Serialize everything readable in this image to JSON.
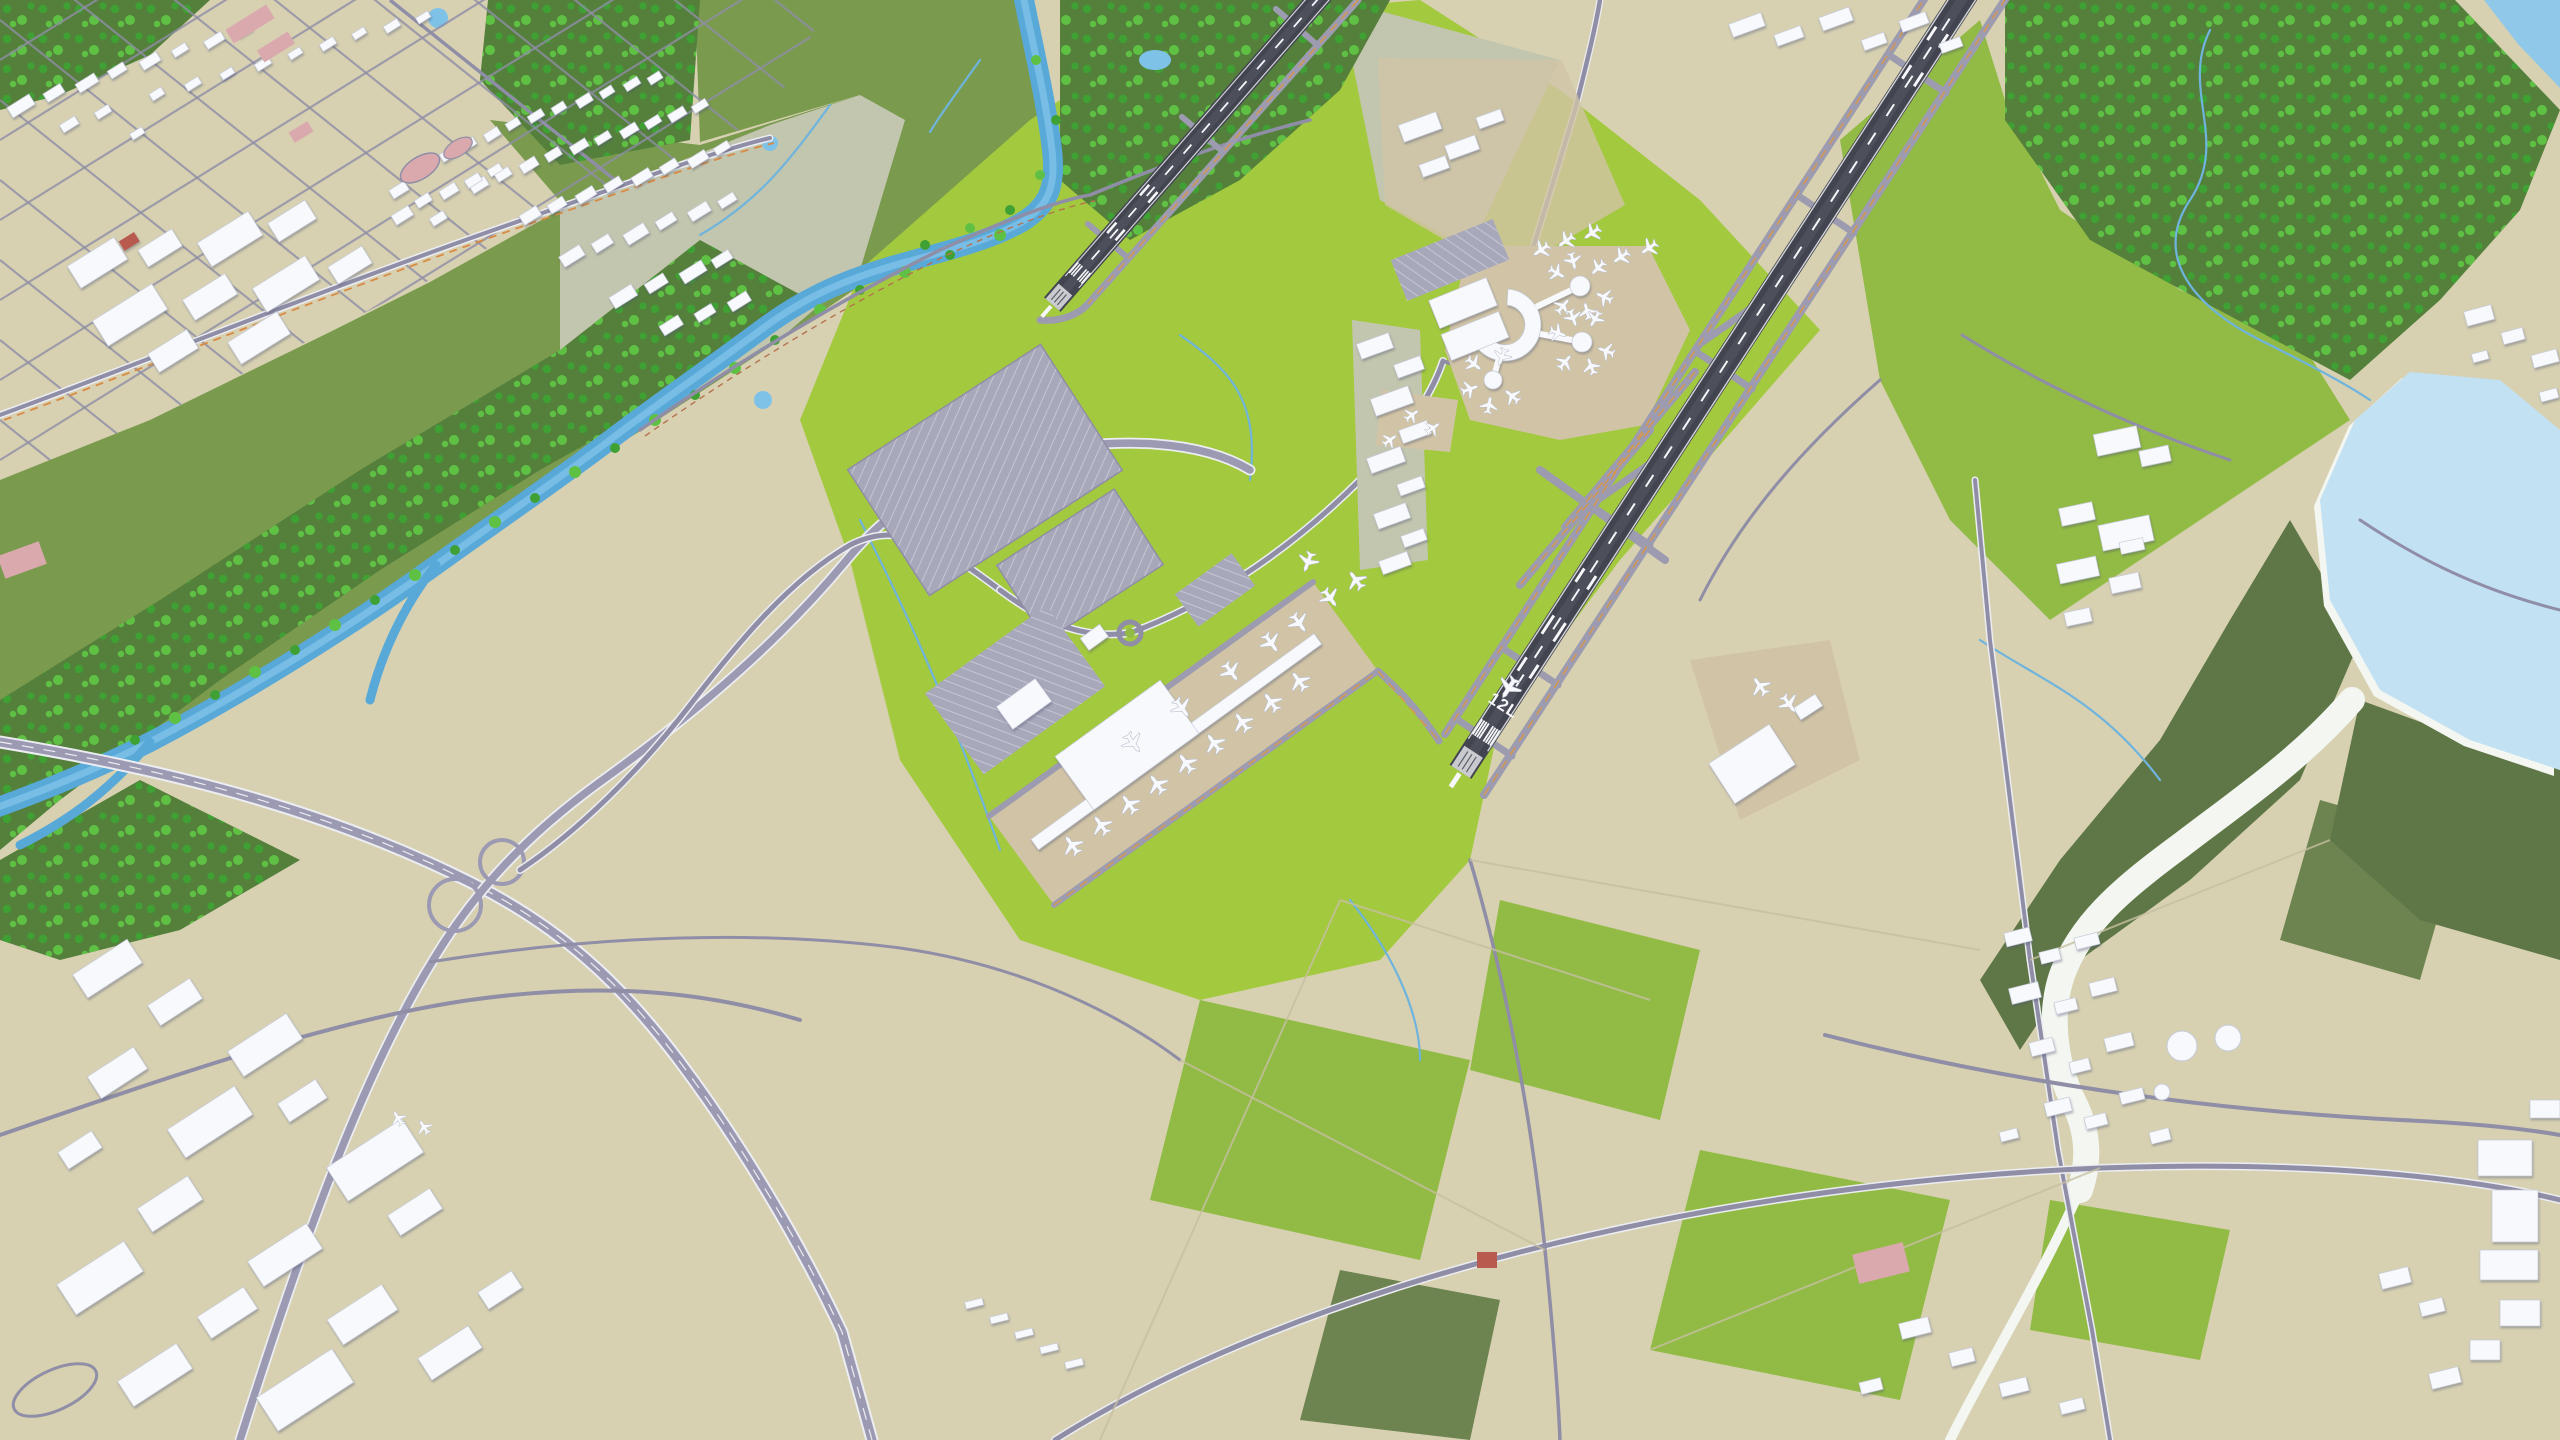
{
  "meta": {
    "type": "3d-aerial-airport-map",
    "description": "Isometric 3D city-model render of an international airport: two dark diagonal runways, crescent main terminal with three satellite concourses, long linear pier terminal with parked jets, taxiway network with orange centerlines, bright grass infields, a tree-lined river, a lake with white dry creek, a town street grid northwest, warehouse district southwest and farmland southeast.",
    "visible_text": "12L"
  },
  "labels": {
    "runway_designator": "12L"
  },
  "palette": {
    "base_land": "#d7d1b2",
    "land_light": "#ded9c0",
    "concrete_pale": "#c3c6ae",
    "grass_bright": "#a3c93e",
    "grass_mid": "#92bb45",
    "grass_dark": "#7a9a4e",
    "olive": "#6e8450",
    "olive_dark": "#5f7747",
    "forest": "#54803c",
    "tree_light": "#5fc143",
    "tree_mid": "#3fa133",
    "river": "#58a9d8",
    "river_light": "#7fc2e8",
    "lake": "#c2e1f2",
    "lake_deep": "#8fc8e8",
    "stream": "#6fb4dd",
    "creek_white": "#f3f6f1",
    "road": "#8f8ea6",
    "road_light": "#ecedf2",
    "highway": "#9b9ab2",
    "taxiway": "#9c9bb0",
    "taxi_center": "#e2973c",
    "runway": "#42454f",
    "runway_light": "#5a5e68",
    "marking": "#f6f7fa",
    "apron": "#d1c4a6",
    "parking": "#a8a8bb",
    "parking_line": "#cfcfdc",
    "building": "#f8f9fc",
    "building_edge": "#c5cad8",
    "pink": "#d9a9ae",
    "red_roof": "#b95a4f",
    "orange_line": "#d98a43",
    "rail_brown": "#b5724e",
    "field_line": "#c6bfa0"
  },
  "features": {
    "water": [
      "river",
      "lake",
      "corner-lake",
      "white-dry-creek",
      "ponds",
      "streams"
    ],
    "airport": [
      "runway-12l",
      "runway-northwest",
      "parallel-taxiways",
      "crescent-main-terminal",
      "satellite-concourse-1",
      "satellite-concourse-2",
      "satellite-concourse-3",
      "linear-pier-terminal",
      "terminal-hall",
      "parking-garages",
      "economy-parking-lots",
      "cargo-apron-northeast",
      "cargo-hangar-southeast",
      "access-roundabout",
      "terminal-loop-roads"
    ],
    "surroundings": [
      "town-grid-northwest",
      "stadium-oval",
      "warehouse-district-southwest",
      "highway-interchange",
      "village-southeast",
      "institutional-campus-east",
      "storage-tanks",
      "farm-fields",
      "riparian-forest",
      "forest-northeast",
      "marsh"
    ]
  },
  "aircraft": {
    "count": 47,
    "placements": [
      [
        1072,
        845,
        -36,
        1.15
      ],
      [
        1101,
        825,
        -36,
        1.15
      ],
      [
        1129,
        804,
        -36,
        1.15
      ],
      [
        1157,
        784,
        -36,
        1.15
      ],
      [
        1186,
        763,
        -36,
        1.15
      ],
      [
        1214,
        743,
        -36,
        1.15
      ],
      [
        1242,
        722,
        -36,
        1.15
      ],
      [
        1271,
        702,
        -36,
        1.15
      ],
      [
        1299,
        681,
        -36,
        1.15
      ],
      [
        1133,
        743,
        144,
        1.15
      ],
      [
        1182,
        708,
        144,
        1.15
      ],
      [
        1231,
        672,
        144,
        1.15
      ],
      [
        1271,
        643,
        144,
        1.15
      ],
      [
        1299,
        623,
        144,
        1.15
      ],
      [
        1330,
        598,
        144,
        1.1
      ],
      [
        1356,
        580,
        -36,
        1.1
      ],
      [
        1308,
        562,
        200,
        1.1
      ],
      [
        1604,
        297,
        -65,
        0.95
      ],
      [
        1587,
        311,
        -15,
        0.95
      ],
      [
        1563,
        306,
        40,
        0.95
      ],
      [
        1557,
        273,
        120,
        0.95
      ],
      [
        1573,
        261,
        165,
        0.95
      ],
      [
        1598,
        268,
        225,
        0.95
      ],
      [
        1606,
        351,
        -70,
        0.95
      ],
      [
        1591,
        366,
        -20,
        0.95
      ],
      [
        1565,
        362,
        40,
        0.95
      ],
      [
        1558,
        333,
        110,
        0.95
      ],
      [
        1573,
        318,
        160,
        0.95
      ],
      [
        1595,
        319,
        210,
        0.95
      ],
      [
        1512,
        396,
        -50,
        0.95
      ],
      [
        1489,
        405,
        10,
        0.95
      ],
      [
        1470,
        389,
        70,
        0.95
      ],
      [
        1474,
        364,
        130,
        0.95
      ],
      [
        1502,
        357,
        200,
        0.95
      ],
      [
        1541,
        250,
        -125,
        1
      ],
      [
        1566,
        241,
        -125,
        1
      ],
      [
        1592,
        233,
        -125,
        1
      ],
      [
        1621,
        257,
        -125,
        1
      ],
      [
        1649,
        248,
        -125,
        1
      ],
      [
        1509,
        688,
        213,
        1.25
      ],
      [
        1789,
        704,
        144,
        1.1
      ],
      [
        1760,
        686,
        -36,
        1.1
      ],
      [
        398,
        1118,
        -33,
        0.85
      ],
      [
        424,
        1127,
        -33,
        0.85
      ],
      [
        1412,
        415,
        54,
        0.85
      ],
      [
        1433,
        428,
        54,
        0.85
      ],
      [
        1390,
        440,
        54,
        0.85
      ]
    ]
  }
}
